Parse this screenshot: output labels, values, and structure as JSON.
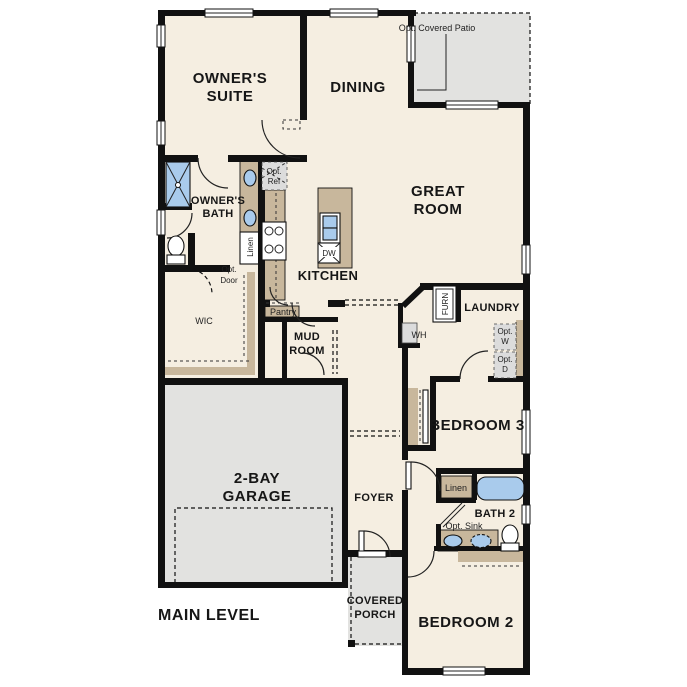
{
  "plan_title": "MAIN LEVEL",
  "rooms": {
    "owners_suite": {
      "lines": [
        "OWNER'S",
        "SUITE"
      ]
    },
    "dining": {
      "label": "DINING"
    },
    "great_room": {
      "lines": [
        "GREAT",
        "ROOM"
      ]
    },
    "owners_bath": {
      "lines": [
        "OWNER'S",
        "BATH"
      ]
    },
    "kitchen": {
      "label": "KITCHEN"
    },
    "wic": {
      "label": "WIC"
    },
    "mud_room": {
      "lines": [
        "MUD",
        "ROOM"
      ]
    },
    "laundry": {
      "label": "LAUNDRY"
    },
    "garage": {
      "lines": [
        "2-BAY",
        "GARAGE"
      ]
    },
    "foyer": {
      "label": "FOYER"
    },
    "bedroom3": {
      "label": "BEDROOM 3"
    },
    "bath2": {
      "label": "BATH 2"
    },
    "bedroom2": {
      "label": "BEDROOM 2"
    },
    "covered_porch": {
      "lines": [
        "COVERED",
        "PORCH"
      ]
    },
    "pantry": {
      "label": "Pantry"
    }
  },
  "annotations": {
    "opt_covered_patio": "Opt. Covered Patio",
    "opt_ref": {
      "lines": [
        "Opt.",
        "Ref"
      ]
    },
    "opt_door": {
      "lines": [
        "Opt.",
        "Door"
      ]
    },
    "linen_owners_bath": "Linen",
    "linen_bath2": "Linen",
    "furnace": "FURN",
    "water_heater": "WH",
    "opt_washer": {
      "lines": [
        "Opt.",
        "W"
      ]
    },
    "opt_dryer": {
      "lines": [
        "Opt.",
        "D"
      ]
    },
    "opt_sink": "Opt. Sink",
    "dishwasher": "DW"
  },
  "colors": {
    "floor": "#f5eee1",
    "outdoor_gray": "#e2e2e0",
    "wall": "#111111",
    "cabinet_tan": "#c8b79c",
    "fixture_blue": "#a9cbec"
  }
}
